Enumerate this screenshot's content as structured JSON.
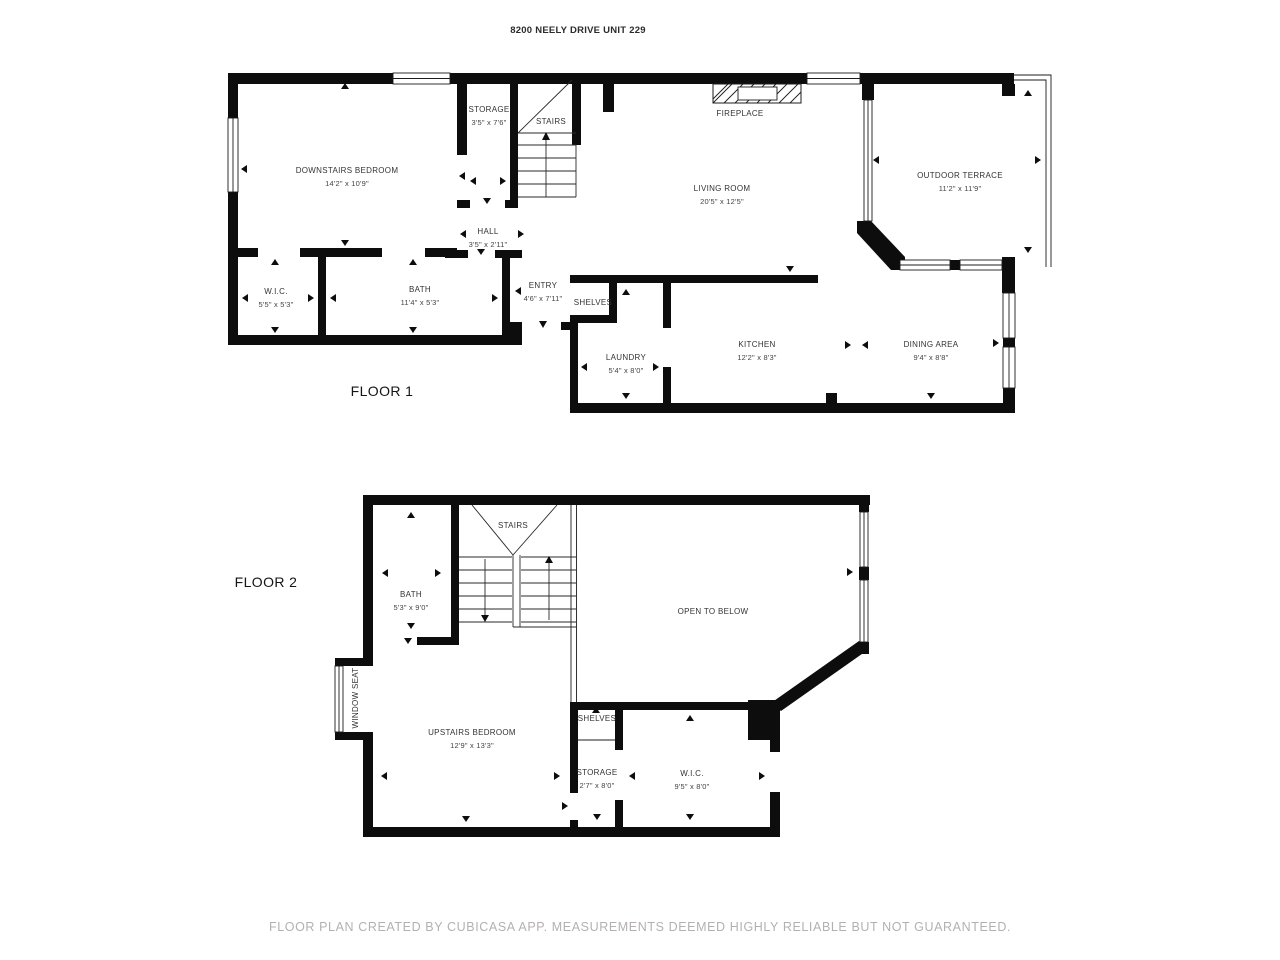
{
  "header": {
    "title": "8200 NEELY DRIVE UNIT 229"
  },
  "footer": {
    "disclaimer": "FLOOR PLAN CREATED BY CUBICASA APP. MEASUREMENTS DEEMED HIGHLY RELIABLE BUT NOT GUARANTEED."
  },
  "floor1": {
    "label": "FLOOR 1",
    "rooms": {
      "bedroom": {
        "name": "DOWNSTAIRS BEDROOM",
        "dims": "14'2\" x 10'9\""
      },
      "storage": {
        "name": "STORAGE",
        "dims": "3'5\" x 7'6\""
      },
      "stairs": {
        "name": "STAIRS"
      },
      "hall": {
        "name": "HALL",
        "dims": "3'5\" x 2'11\""
      },
      "living": {
        "name": "LIVING ROOM",
        "dims": "20'5\" x 12'5\""
      },
      "fireplace": {
        "name": "FIREPLACE"
      },
      "terrace": {
        "name": "OUTDOOR TERRACE",
        "dims": "11'2\" x 11'9\""
      },
      "wic": {
        "name": "W.I.C.",
        "dims": "5'5\" x 5'3\""
      },
      "bath": {
        "name": "BATH",
        "dims": "11'4\" x 5'3\""
      },
      "entry": {
        "name": "ENTRY",
        "dims": "4'6\" x 7'11\""
      },
      "shelves": {
        "name": "SHELVES"
      },
      "laundry": {
        "name": "LAUNDRY",
        "dims": "5'4\" x 8'0\""
      },
      "kitchen": {
        "name": "KITCHEN",
        "dims": "12'2\" x 8'3\""
      },
      "dining": {
        "name": "DINING AREA",
        "dims": "9'4\" x 8'8\""
      }
    }
  },
  "floor2": {
    "label": "FLOOR 2",
    "rooms": {
      "stairs": {
        "name": "STAIRS"
      },
      "bath": {
        "name": "BATH",
        "dims": "5'3\" x 9'0\""
      },
      "open_below": {
        "name": "OPEN TO BELOW"
      },
      "window_seat": {
        "name": "WINDOW SEAT"
      },
      "bedroom": {
        "name": "UPSTAIRS BEDROOM",
        "dims": "12'9\" x 13'3\""
      },
      "shelves": {
        "name": "SHELVES"
      },
      "storage": {
        "name": "STORAGE",
        "dims": "2'7\" x 8'0\""
      },
      "wic": {
        "name": "W.I.C.",
        "dims": "9'5\" x 8'0\""
      }
    }
  }
}
